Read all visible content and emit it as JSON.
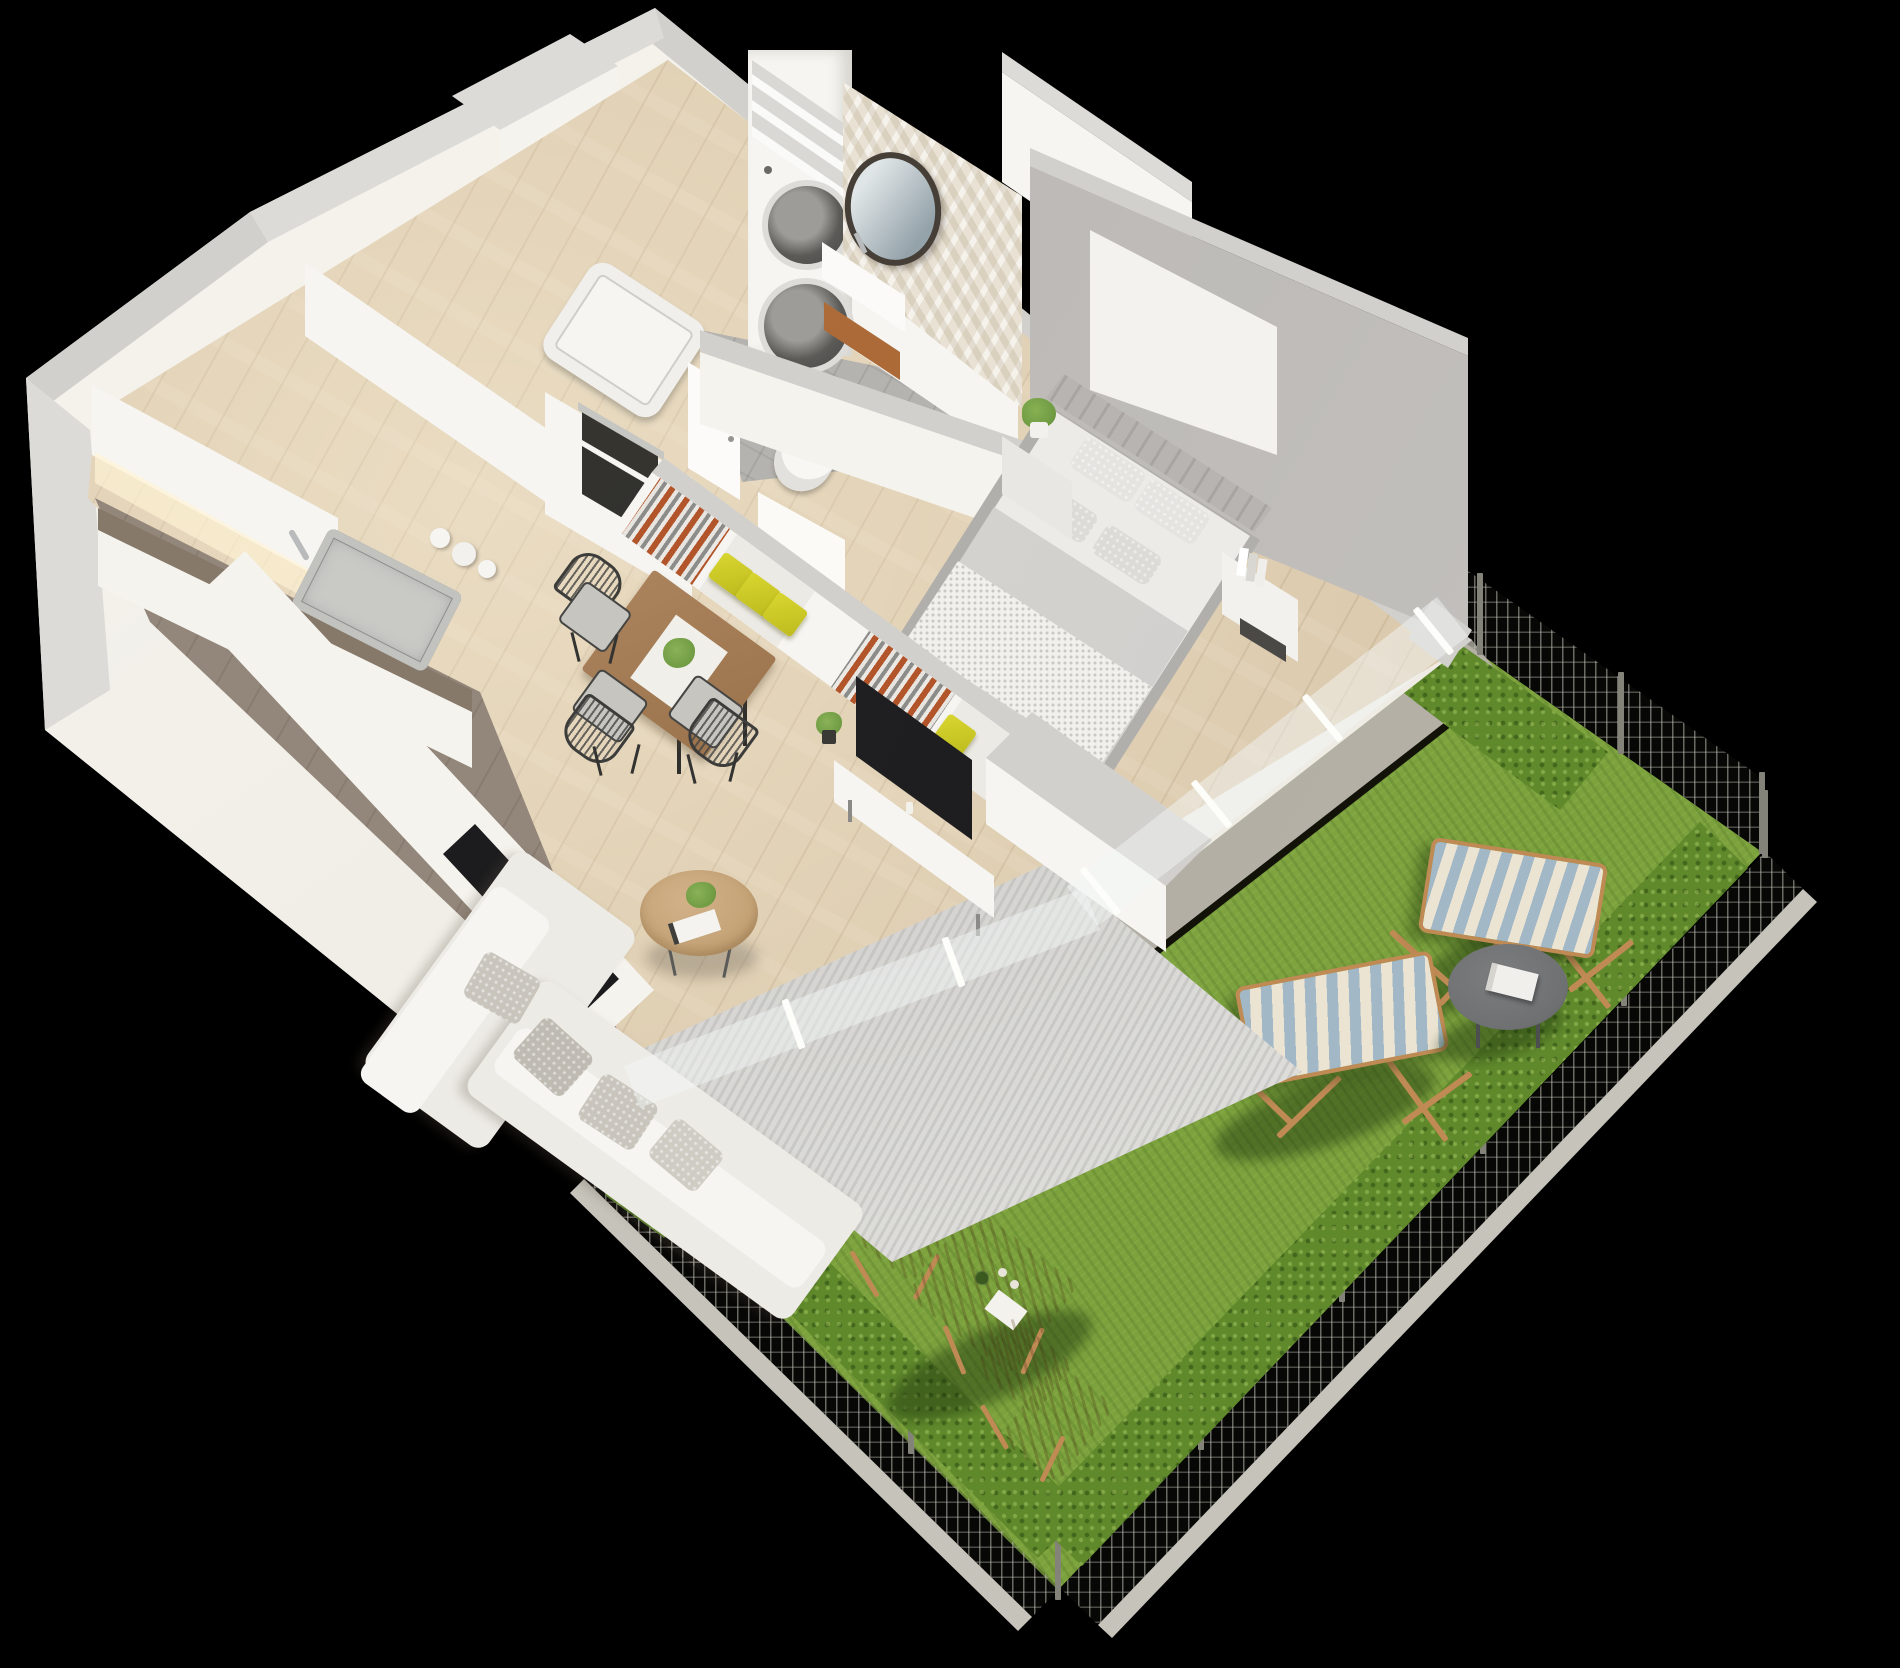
{
  "scene": {
    "title": "3D isometric cutaway floor plan of a one-bedroom apartment with private garden",
    "view": "axonometric bird's-eye render on black background",
    "rooms": [
      {
        "name": "kitchen",
        "items": [
          "white upper cabinets",
          "counter with stainless sink and faucet",
          "white vases",
          "tall cabinet with built-in microwave and oven",
          "second counter run",
          "black induction hob"
        ]
      },
      {
        "name": "hallway",
        "items": [
          "entrance door",
          "tall pantry cabinets",
          "two white wardrobe blocks"
        ]
      },
      {
        "name": "bathroom",
        "items": [
          "stacked washer and dryer column",
          "open shelves",
          "round black-framed mirror",
          "white wall-hung basin",
          "wooden stool",
          "toilet",
          "bathtub",
          "beige mosaic feature wall",
          "bathroom door"
        ]
      },
      {
        "name": "bedroom",
        "items": [
          "double bed with grey bedding and pillows",
          "channel-tufted headboard",
          "large abstract artwork in grey and gold",
          "grey accent wall",
          "nightstand with potted plant",
          "nightstand with books"
        ]
      },
      {
        "name": "living-dining",
        "items": [
          "open wardrobe partition with hanging clothes and yellow storage boxes",
          "flat-screen TV on white media bench",
          "small potted plants",
          "L-shaped light grey corner sofa with textured cushions",
          "round wooden coffee table with plant and magazines",
          "mottled grey area rug",
          "square wooden dining table with white runner and plant",
          "three dark wire dining chairs"
        ]
      },
      {
        "name": "garden-terrace",
        "items": [
          "green lawn",
          "grey paved walkway along glazed facade",
          "white patio slab",
          "boxwood hedge rows",
          "wire mesh fence with grey posts and concrete curb",
          "garden gate",
          "two wood-framed striped deck chairs",
          "round dark grey side table with book",
          "folding wooden bistro table with bottle, glasses and napkin",
          "two folding wooden bistro chairs"
        ]
      }
    ],
    "glazing": "floor-to-ceiling windows facing the garden",
    "palette": {
      "bg": "#000000",
      "wall-top": "#d1d0cc",
      "wall-face": "#eeece4",
      "accent-wall": "#b6b3b0",
      "mosaic": "#e9e2d4",
      "wood": "#d9c7aa",
      "kitchen-floor": "#93867a",
      "bath-floor": "#b5b3af",
      "counter": "#87796a",
      "appliance": "#1c1c1e",
      "grass": "#7ca23d",
      "hedge": "#60892c",
      "walkway": "#aca89e",
      "patio": "#edebe1",
      "curb": "#c6c3ba",
      "fence-post": "#84837a",
      "deck-blue": "#a3b8c6",
      "deck-cream": "#ece4d2",
      "deck-wood": "#c08a55",
      "bistro-wood": "#b9854f",
      "side-table": "#6e7072",
      "rug": "#e5e4e1",
      "sofa": "#edebe6",
      "pillow": "#c9c5bd",
      "bed-sheet": "#ecebe7",
      "duvet": "#d9d7d4",
      "headboard": "#b7b4b1",
      "yellow-box": "#d9d630",
      "clothes-orange": "#b3552a",
      "tv": "#1f1f21",
      "plant": "#6f9b43",
      "table-wood": "#aa825c",
      "artwork-gold": "#c8a469"
    }
  }
}
